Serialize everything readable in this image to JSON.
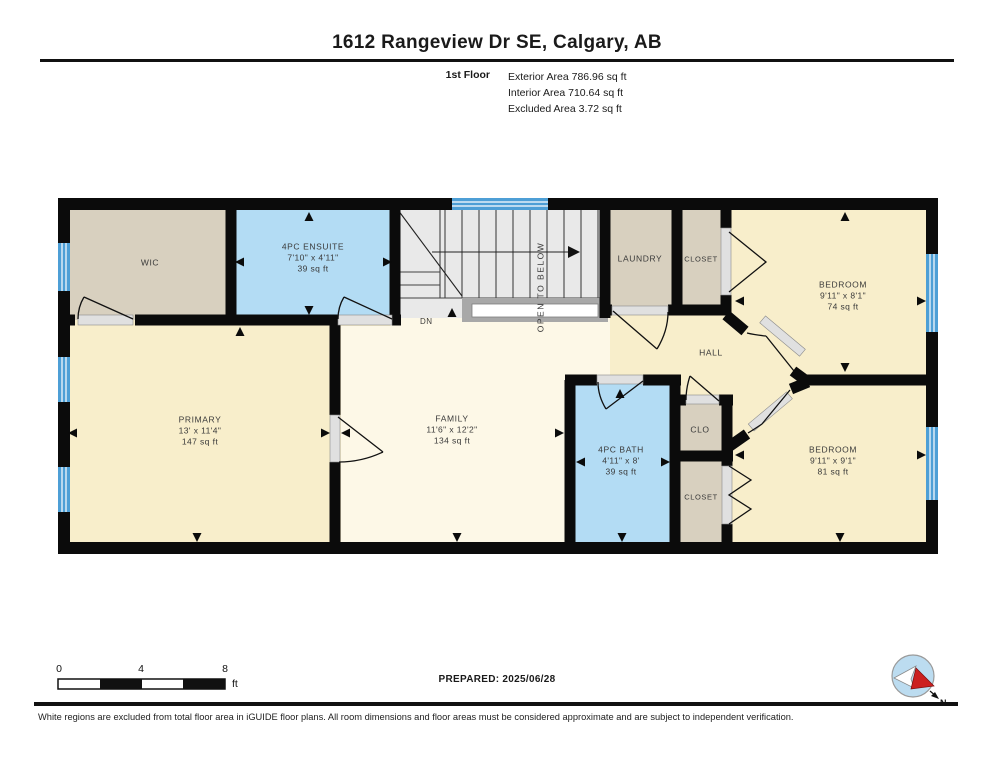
{
  "header": {
    "title": "1612 Rangeview Dr SE, Calgary, AB",
    "floor_label": "1st Floor",
    "areas": [
      "Exterior Area 786.96 sq ft",
      "Interior Area 710.64 sq ft",
      "Excluded Area 3.72 sq ft"
    ]
  },
  "rooms": {
    "wic": {
      "name": "WIC"
    },
    "ensuite": {
      "name": "4PC ENSUITE",
      "dims": "7'10\" x 4'11\"",
      "area": "39 sq ft"
    },
    "laundry": {
      "name": "LAUNDRY"
    },
    "closet_top": {
      "name": "CLOSET"
    },
    "bedroom_top": {
      "name": "BEDROOM",
      "dims": "9'11\" x 8'1\"",
      "area": "74 sq ft"
    },
    "hall": {
      "name": "HALL"
    },
    "primary": {
      "name": "PRIMARY",
      "dims": "13' x 11'4\"",
      "area": "147 sq ft"
    },
    "family": {
      "name": "FAMILY",
      "dims": "11'6\" x 12'2\"",
      "area": "134 sq ft"
    },
    "bath": {
      "name": "4PC BATH",
      "dims": "4'11\" x 8'",
      "area": "39 sq ft"
    },
    "clo": {
      "name": "CLO"
    },
    "closet_bottom": {
      "name": "CLOSET"
    },
    "bedroom_bottom": {
      "name": "BEDROOM",
      "dims": "9'11\" x 9'1\"",
      "area": "81 sq ft"
    }
  },
  "stairs": {
    "dn_label": "DN",
    "open_label": "OPEN TO BELOW"
  },
  "scale_bar": {
    "t0": "0",
    "t1": "4",
    "t2": "8",
    "unit": "ft"
  },
  "footer": {
    "prepared": "PREPARED: 2025/06/28",
    "compass_n": "N",
    "disclaimer": "White regions are excluded from total floor area in iGUIDE floor plans. All room dimensions and floor areas must be considered approximate and are subject to independent verification."
  },
  "colors": {
    "wall": "#0b0b0b",
    "room_cream": "#f8eecb",
    "room_cream_light": "#fdf8e7",
    "room_tan": "#d8d0bf",
    "room_blue": "#b3dcf4",
    "stairs_gray": "#e9e9e9",
    "window_blue": "#4d9fd6",
    "compass_blue": "#bcdcf0",
    "compass_red": "#cc1f1f"
  }
}
